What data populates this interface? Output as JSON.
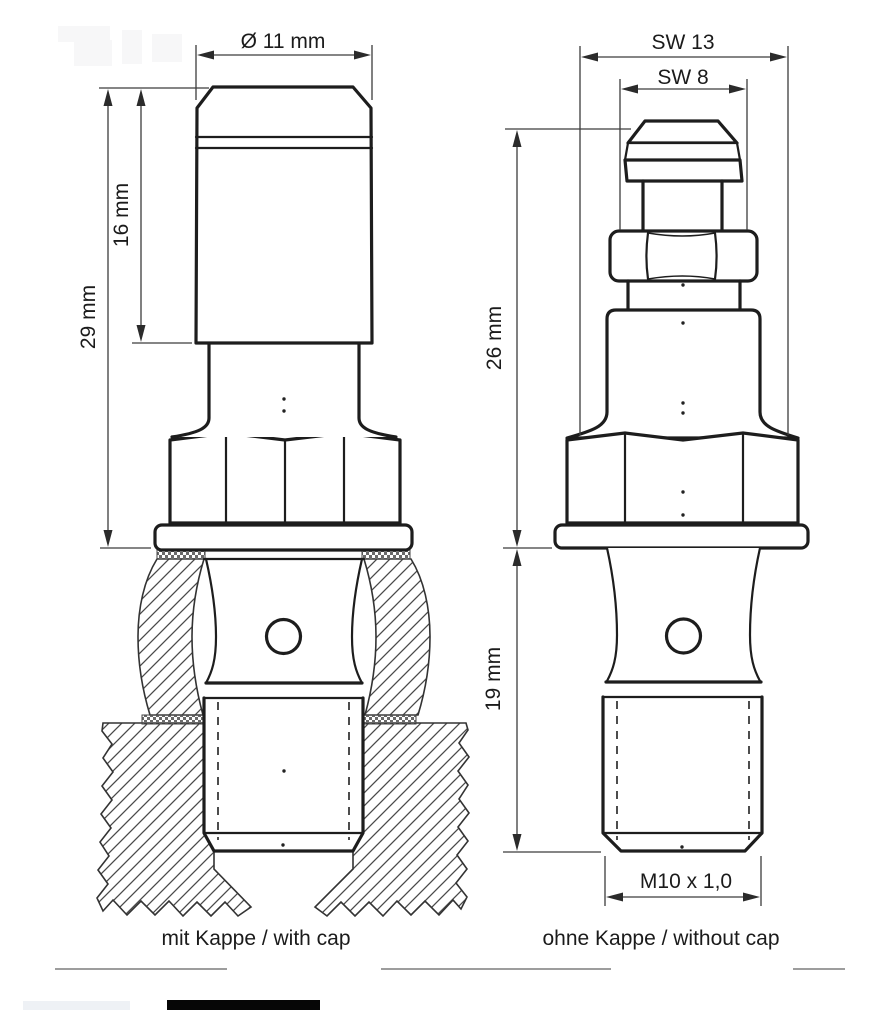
{
  "left_view": {
    "caption": "mit Kappe / with cap",
    "dim_diameter": "Ø 11 mm",
    "dim_cap_height": "16 mm",
    "dim_total_height": "29 mm"
  },
  "right_view": {
    "caption": "ohne Kappe / without cap",
    "dim_hex_large": "SW 13",
    "dim_hex_small": "SW 8",
    "dim_upper_height": "26 mm",
    "dim_thread_length": "19 mm",
    "dim_thread_spec": "M10 x 1,0"
  },
  "colors": {
    "background": "#ffffff",
    "line": "#1d1d1d",
    "dimension_line": "#3c3c3c",
    "hatch": "#474747",
    "text": "#1b1b1b",
    "underline": "#7d7d7d",
    "bottom_bar_black": "#060606",
    "bottom_bar_light": "#eef1f5"
  }
}
